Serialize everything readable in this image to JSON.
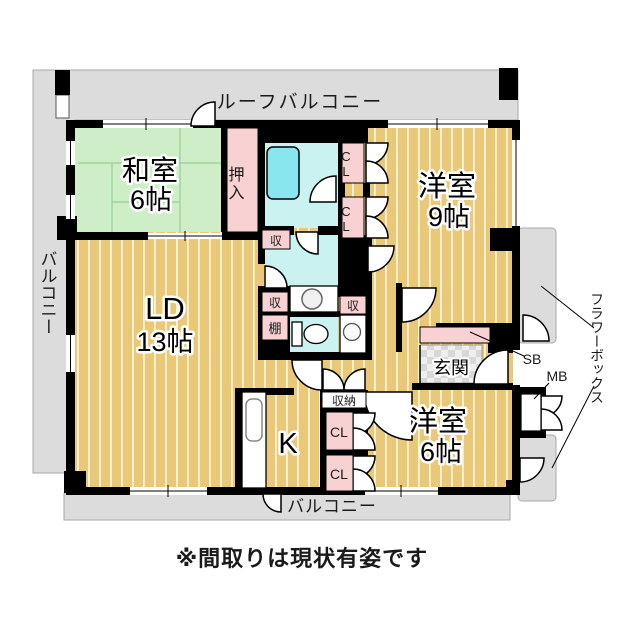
{
  "caption": "※間取りは現状有姿です",
  "balconies": {
    "roof": "ルーフバルコニー",
    "left": "バルコニー",
    "bottom": "バルコニー"
  },
  "exterior": {
    "flower_box": "フラワーボックス",
    "shoe_box": "SB",
    "meter_box": "MB"
  },
  "rooms": {
    "washitsu": {
      "name": "和室",
      "size": "6帖"
    },
    "living_dining": {
      "name": "LD",
      "size": "13帖"
    },
    "western_9": {
      "name": "洋室",
      "size": "9帖"
    },
    "western_6": {
      "name": "洋室",
      "size": "6帖"
    },
    "kitchen": {
      "name": "K"
    },
    "entrance": {
      "name": "玄関"
    },
    "oshiire": {
      "name": "押入"
    }
  },
  "storage": {
    "cl": "CL",
    "shu": "収",
    "tana": "棚",
    "shuno": "収納"
  },
  "colors": {
    "floor_wood": "#e9c878",
    "tatami_green": "#cdeec6",
    "water_cyan": "#c9f2f0",
    "bathtub": "#8ae6ee",
    "closet_pink": "#f8d2d2",
    "balcony_gray": "#dcdcdc",
    "wall": "#000000"
  }
}
